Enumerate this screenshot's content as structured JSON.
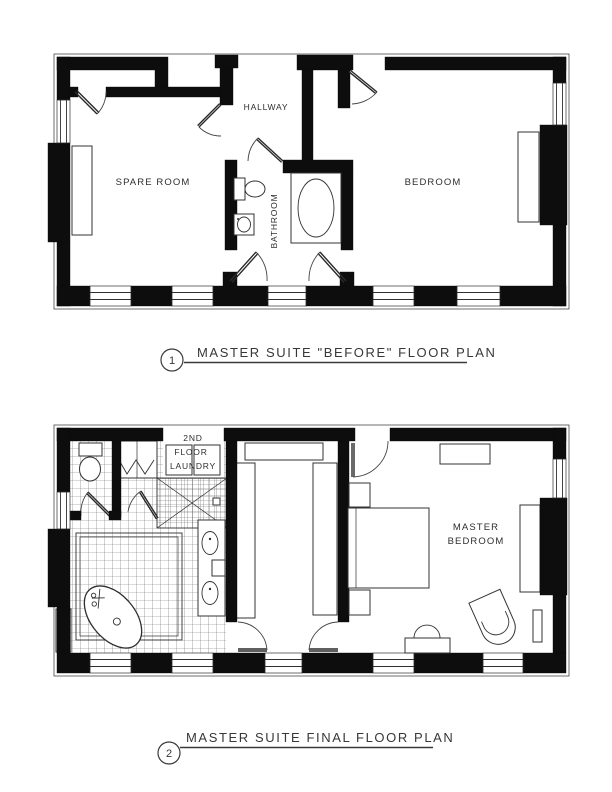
{
  "document": {
    "type": "architectural floor plan sheet",
    "background": "#ffffff",
    "wall_color": "#0d0d0d",
    "line_color": "#2f2f2f"
  },
  "plan_before": {
    "number": "1",
    "title": "MASTER SUITE \"BEFORE\" FLOOR PLAN",
    "rooms": {
      "spare_room": "SPARE ROOM",
      "hallway": "HALLWAY",
      "bathroom": "BATHROOM",
      "bedroom": "BEDROOM"
    },
    "fixtures": [
      "toilet",
      "sink",
      "bathtub",
      "window-seat",
      "window-seat"
    ]
  },
  "plan_final": {
    "number": "2",
    "title": "MASTER SUITE FINAL FLOOR PLAN",
    "labels": {
      "laundry_line1": "2ND",
      "laundry_line2": "FLOOR",
      "laundry_line3": "LAUNDRY",
      "master_line1": "MASTER",
      "master_line2": "BEDROOM"
    },
    "fixtures": [
      "toilet",
      "shower",
      "double-vanity",
      "freestanding-tub",
      "washer",
      "dryer",
      "linen-closet",
      "wardrobes",
      "bed",
      "nightstands",
      "dresser",
      "armchair",
      "bench",
      "window-seat",
      "window-seat"
    ]
  }
}
